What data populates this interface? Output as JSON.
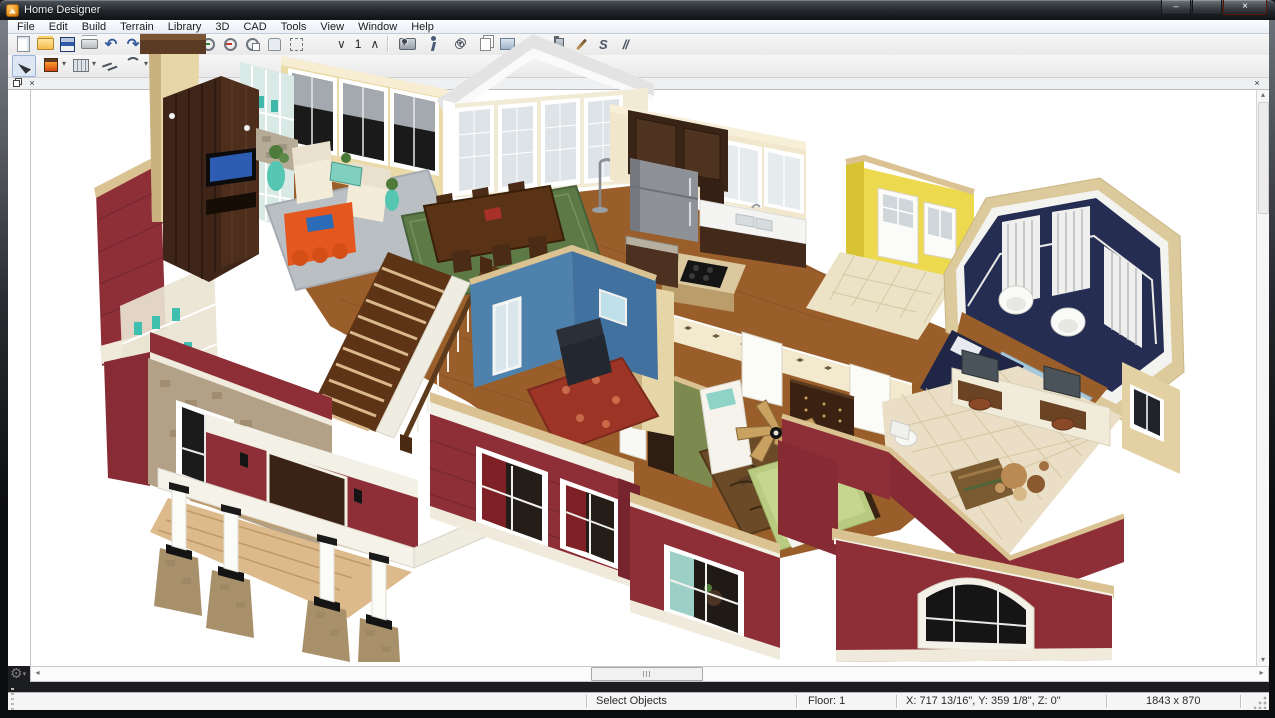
{
  "window": {
    "title": "Home Designer",
    "controls": [
      {
        "name": "minimize-button",
        "glyph": "–"
      },
      {
        "name": "maximize-button",
        "glyph": ""
      },
      {
        "name": "close-button",
        "glyph": "×"
      }
    ]
  },
  "menu_bar": {
    "items": [
      "File",
      "Edit",
      "Build",
      "Terrain",
      "Library",
      "3D",
      "CAD",
      "Tools",
      "View",
      "Window",
      "Help"
    ]
  },
  "toolbar_file": {
    "icons": [
      {
        "name": "new-plan-icon"
      },
      {
        "name": "open-plan-icon"
      },
      {
        "name": "save-plan-icon"
      },
      {
        "name": "print-icon"
      },
      {
        "name": "undo-icon",
        "glyph": "↶"
      },
      {
        "name": "redo-icon",
        "glyph": "↷"
      },
      {
        "name": "library-browser-icon"
      },
      {
        "name": "help-icon",
        "glyph": "?"
      }
    ]
  },
  "toolbar_zoom": {
    "icons": [
      {
        "name": "zoom-in-icon"
      },
      {
        "name": "zoom-out-icon"
      },
      {
        "name": "selected-zoom-icon"
      },
      {
        "name": "pan-icon"
      },
      {
        "name": "fill-window-icon"
      }
    ]
  },
  "floor_selector": {
    "down_glyph": "∨",
    "value": "1",
    "up_glyph": "∧"
  },
  "toolbar_view": {
    "icons": [
      {
        "name": "camera-icon",
        "dropdown": true
      },
      {
        "name": "walkthrough-icon"
      },
      {
        "name": "glasses-icon",
        "dropdown": true
      },
      {
        "name": "copy-view-icon"
      },
      {
        "name": "export-picture-icon"
      },
      {
        "name": "render-technique-icon",
        "dropdown": true
      },
      {
        "name": "spray-material-icon"
      },
      {
        "name": "eyedropper-icon"
      },
      {
        "name": "spline-icon",
        "glyph": "S"
      },
      {
        "name": "hatch-icon",
        "glyph": "//"
      }
    ]
  },
  "toolbar_edit": {
    "icons": [
      {
        "name": "select-objects-icon",
        "pressed": true
      },
      {
        "name": "fireplace-icon",
        "dropdown": true
      },
      {
        "name": "straight-wall-icon",
        "dropdown": true
      },
      {
        "name": "break-line-icon"
      },
      {
        "name": "curve-line-icon",
        "dropdown": true
      },
      {
        "name": "dimension-icon",
        "glyph": "↔",
        "dropdown": true
      }
    ]
  },
  "view_pane": {
    "close_glyph": "×"
  },
  "scrollbar": {
    "left": "◂",
    "right": "▸",
    "up": "▴",
    "down": "▾"
  },
  "config_button": {
    "glyph": "⚙",
    "arrow": "▾"
  },
  "status_bar": {
    "mode": "Select Objects",
    "floor": "Floor: 1",
    "coordinates": "X: 717 13/16\", Y: 359 1/8\", Z: 0\"",
    "view_size": "1843 x 870"
  },
  "palette": {
    "siding_red": "#8e2f38",
    "trim_cream": "#dac292",
    "wood_floor": "#9a5e2b",
    "accent_orange": "#e4571f",
    "navy_wall": "#262d52",
    "yellow_wall": "#ecd94e",
    "blue_wall": "#4f81ad",
    "green_wall": "#7c8a50",
    "stone": "#b2a187"
  }
}
